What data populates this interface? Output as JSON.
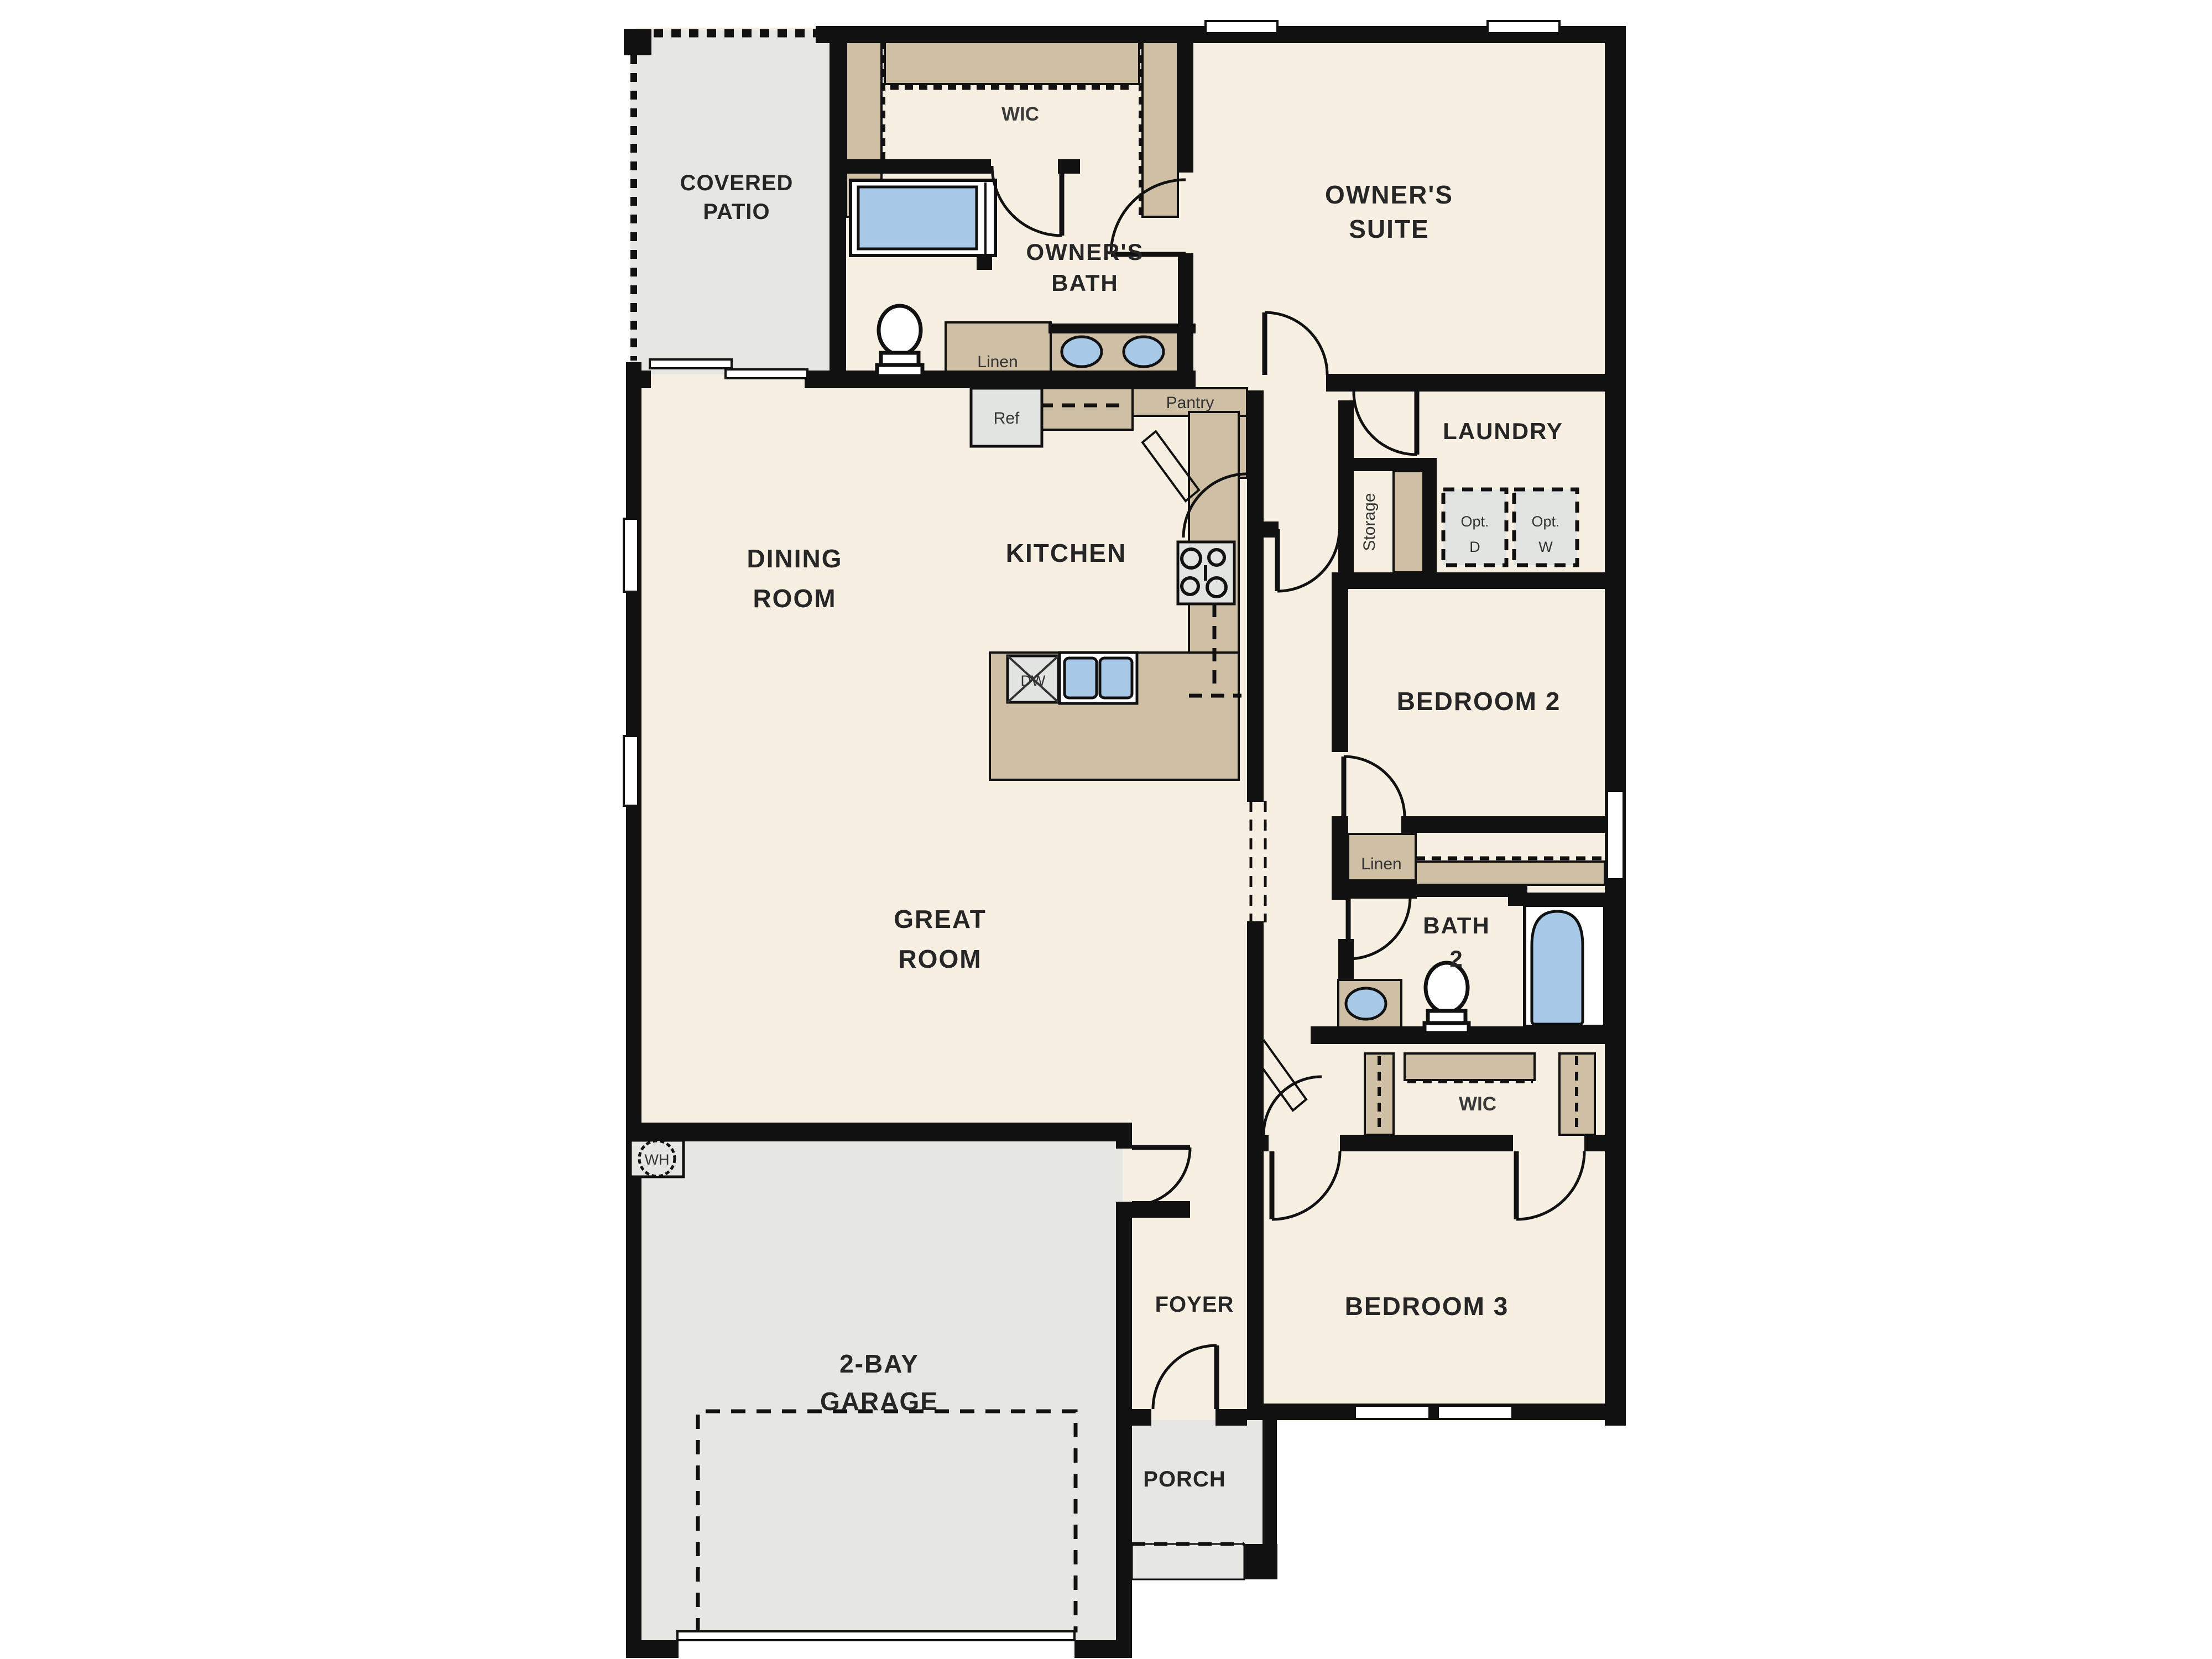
{
  "labels": {
    "covered_patio": [
      "COVERED",
      "PATIO"
    ],
    "wic_owner": "WIC",
    "owners_bath": [
      "OWNER'S",
      "BATH"
    ],
    "owners_suite": [
      "OWNER'S",
      "SUITE"
    ],
    "linen_owner": "Linen",
    "ref": "Ref",
    "pantry": "Pantry",
    "laundry": "LAUNDRY",
    "storage": "Storage",
    "opt_dryer": [
      "Opt.",
      "D"
    ],
    "opt_washer": [
      "Opt.",
      "W"
    ],
    "dining_room": [
      "DINING",
      "ROOM"
    ],
    "kitchen": "KITCHEN",
    "dishwasher": "DW",
    "bedroom2": "BEDROOM 2",
    "great_room": [
      "GREAT",
      "ROOM"
    ],
    "linen_hall": "Linen",
    "bath2": [
      "BATH",
      "2"
    ],
    "wic_bedroom3": "WIC",
    "bedroom3": "BEDROOM 3",
    "foyer": "FOYER",
    "garage": [
      "2-BAY",
      "GARAGE"
    ],
    "porch": "PORCH",
    "water_heater": "WH"
  },
  "palette": {
    "wall": "#111111",
    "floor": "#f6efe2",
    "outdoor_gray": "#e6e6e3",
    "cabinet_tan": "#cfc0a5",
    "fixture_blue": "#a8c8e8",
    "appliance_gray": "#e2e4e2"
  }
}
